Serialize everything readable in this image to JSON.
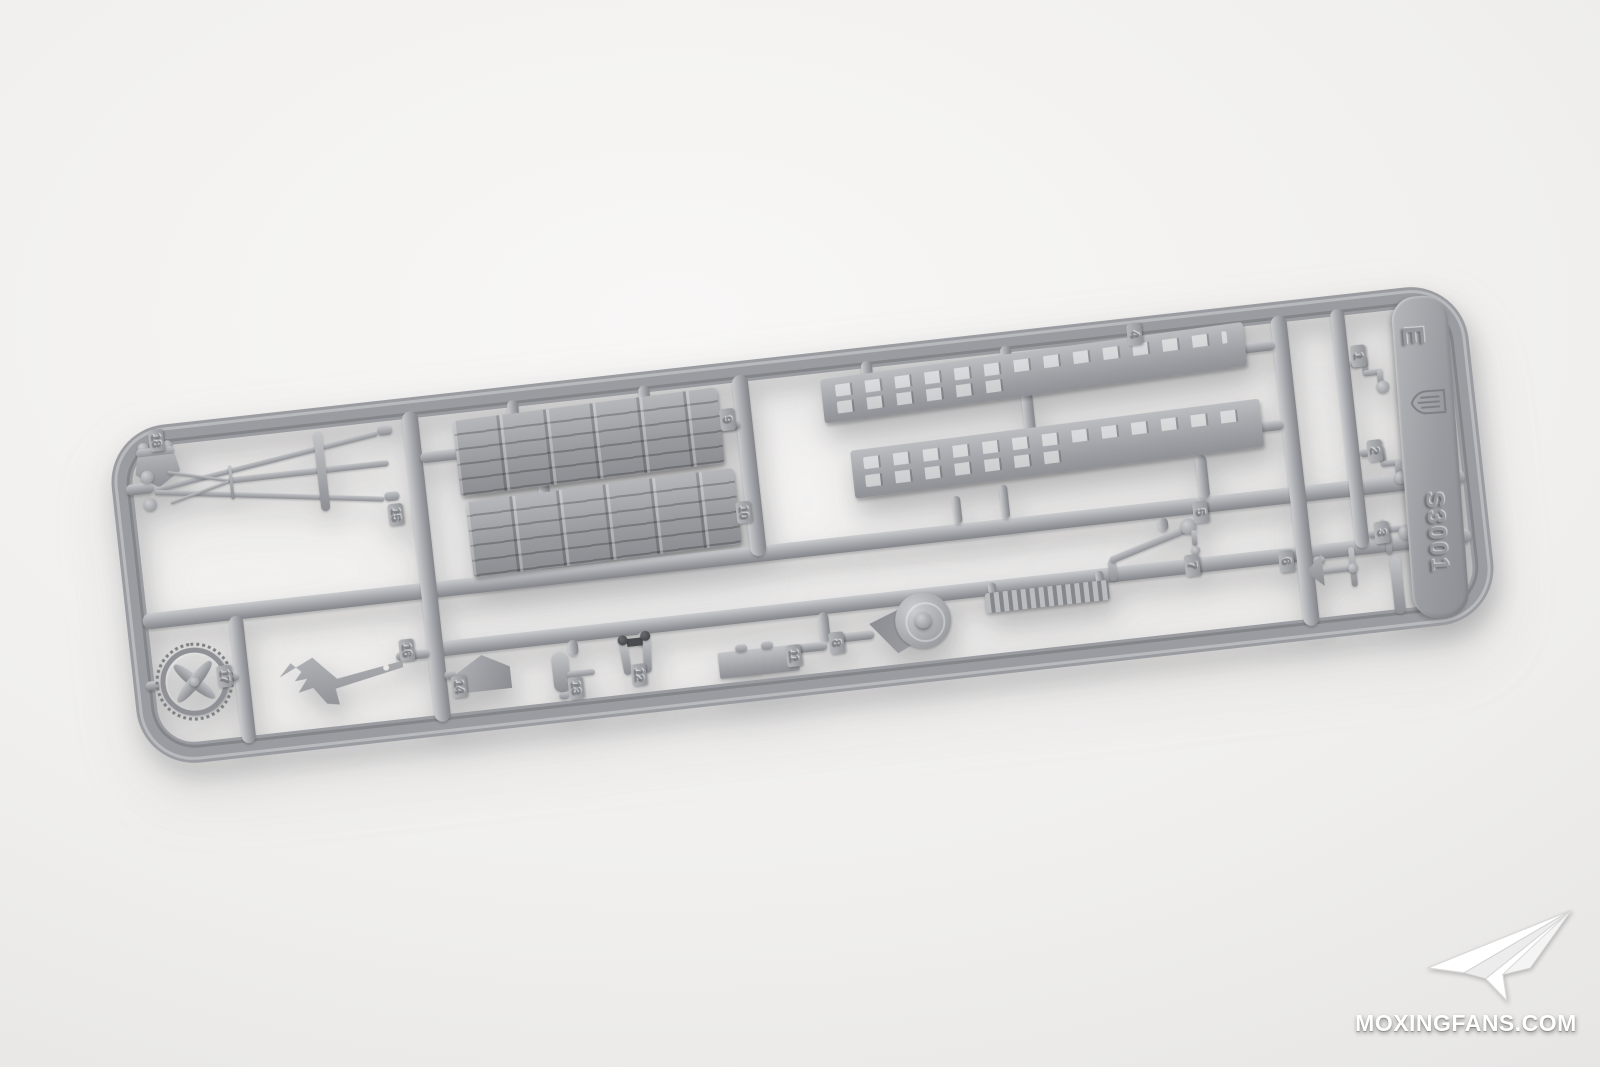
{
  "sprue": {
    "code": "S3001",
    "letter": "E",
    "part_numbers": [
      "1",
      "2",
      "3",
      "4",
      "5",
      "6",
      "7",
      "8",
      "9",
      "10",
      "11",
      "12",
      "13",
      "14",
      "15",
      "16",
      "17",
      "18"
    ],
    "plastic_color": "#9b9da2"
  },
  "watermark": {
    "text": "MOXINGFANS.COM",
    "color": "#ffffff"
  },
  "background": {
    "center_color": "#f8f7f6",
    "edge_color": "#dcdbda"
  }
}
